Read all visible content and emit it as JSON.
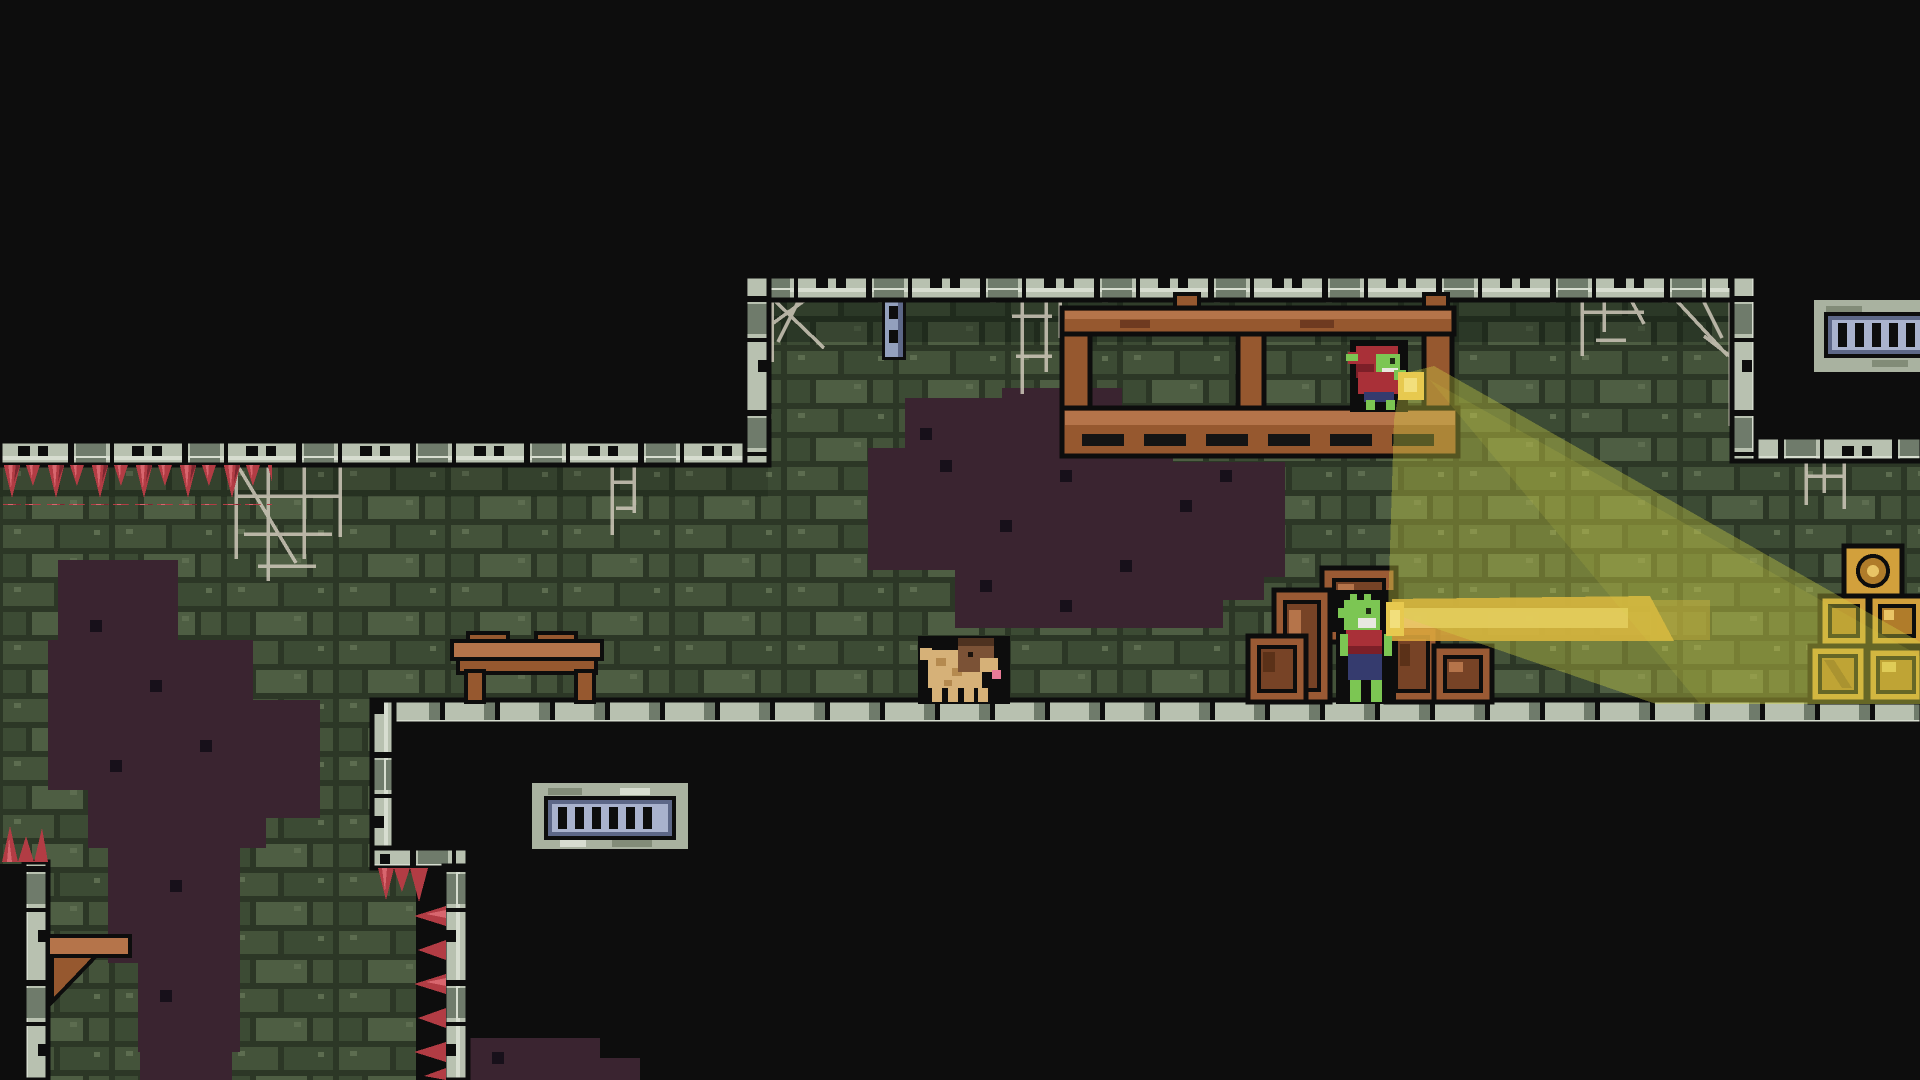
{
  "meta": {
    "type": "game-screenshot",
    "genre": "2D pixel-art dungeon platformer",
    "resolution": "1920x1080",
    "hud_text": "none visible"
  },
  "colors": {
    "bg": "#0d0d0d",
    "mortar": "#2c3726",
    "brick_a": "#44533a",
    "brick_b": "#3c4b34",
    "brick_c": "#4e5e43",
    "brick_speck": "#5d6d50",
    "stone_l": "#b8c1b0",
    "stone_d": "#6f7b6b",
    "stone_hl": "#d7ddd0",
    "wood_l": "#b5744a",
    "wood_m": "#96582f",
    "wood_d": "#6e3a20",
    "crate_f": "#9a5a34",
    "crate_p": "#774326",
    "crate_d": "#5b3118",
    "gold_f": "#d2a03c",
    "gold_p": "#b07c2a",
    "gold_d": "#8a5f20",
    "gold_hl": "#e9c566",
    "spike": "#b23c44",
    "spike_d": "#7c2730",
    "spike_hl": "#d8666e",
    "web": "#cfc8ba",
    "chain": "#93a0bd",
    "chain_d": "#5d6787",
    "vent_bar": "#a9b2cd",
    "vent_fr": "#5d6787",
    "vent_stone": "#a9b2a0",
    "vent_stone_d": "#828c78",
    "mold": "#3a2430",
    "mold_d": "#17101a",
    "skin": "#7cc653",
    "skin_d": "#4f8d33",
    "red": "#a93038",
    "red_d": "#7c1f28",
    "pants": "#353b6e",
    "white": "#e8e8e0",
    "dog_body": "#d6b178",
    "dog_sh": "#b58a4f",
    "dog_head": "#7b5236",
    "dog_ear": "#4e3220",
    "tongue": "#e87a96",
    "beam": "#d2d545",
    "beam_gold": "#d9a43c",
    "beam_gold_hl": "#eecb6d",
    "flame": "#e7c94f",
    "flame_hl": "#f2df7c",
    "outline": "#0d0d0d"
  },
  "entities": {
    "viewport": {
      "label": "dungeon cavern scene with upper gallery, main hall and lower-left pit passage"
    },
    "goblin_upper": {
      "name": "hooded-goblin",
      "label": "Goblin in red hood holding a torch, standing on wooden scaffold platform"
    },
    "goblin_lower": {
      "name": "goblin-by-crates",
      "label": "Goblin in red shirt standing among wooden crates, shining a torch to the right"
    },
    "dog": {
      "name": "pug-dog",
      "label": "Tan pug dog walking on the main floor"
    },
    "scaffold": {
      "label": "Wooden scaffold with platform under the gallery ceiling"
    },
    "table": {
      "label": "Wooden table on the main floor"
    },
    "shelf": {
      "label": "Wooden wall shelf bracket in the pit passage"
    },
    "crates": {
      "label": "Pile of wooden crates",
      "count": 5
    },
    "lit_crates": {
      "label": "Stack of crates lit gold by torchlight at right edge",
      "count": 5
    },
    "vent_lower": {
      "label": "Barred vent grate below the floor"
    },
    "vent_upper_right": {
      "label": "Barred vent grate at top right edge"
    },
    "chain": {
      "label": "Metal chain hanging from gallery ceiling"
    },
    "cobwebs": {
      "label": "Cobwebs on ceilings and corners",
      "count": 7
    },
    "spikes_ceiling": {
      "label": "Red spikes hanging under the left ceiling"
    },
    "spikes_pit": {
      "label": "Red spikes lining the pit passage walls"
    },
    "mold": {
      "label": "Dark mold patches on brick walls",
      "count": 6
    },
    "torch_beam": {
      "label": "Yellow torch light cone fanning down-right onto the crates"
    },
    "torch_beam_gold": {
      "label": "Horizontal golden torch beam from lower goblin"
    }
  }
}
